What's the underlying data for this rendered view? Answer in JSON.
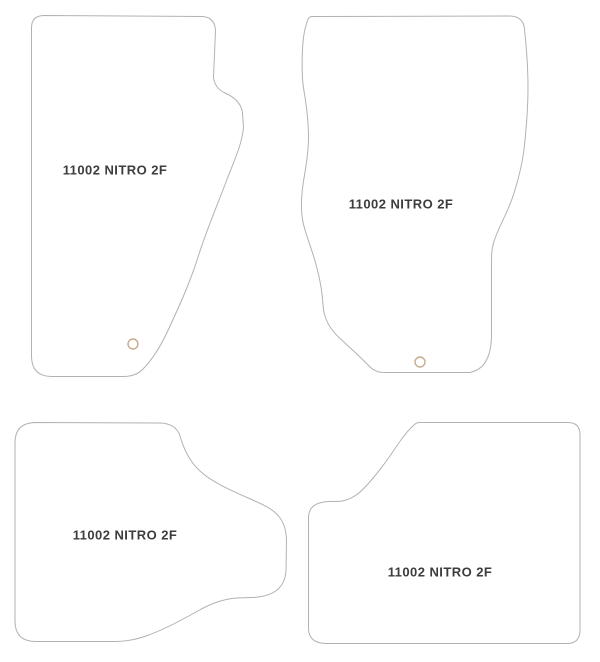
{
  "diagram": {
    "description_visible_text_only": "",
    "mats": [
      {
        "position": "front-left",
        "label": "11002 NITRO 2F"
      },
      {
        "position": "front-right",
        "label": "11002 NITRO 2F"
      },
      {
        "position": "rear-left",
        "label": "11002 NITRO 2F"
      },
      {
        "position": "rear-right",
        "label": "11002 NITRO 2F"
      }
    ]
  },
  "colors": {
    "background": "#ffffff",
    "outline": "#b2b2b2",
    "text": "#3d3d3d",
    "grommet": "#c8ab8d"
  }
}
